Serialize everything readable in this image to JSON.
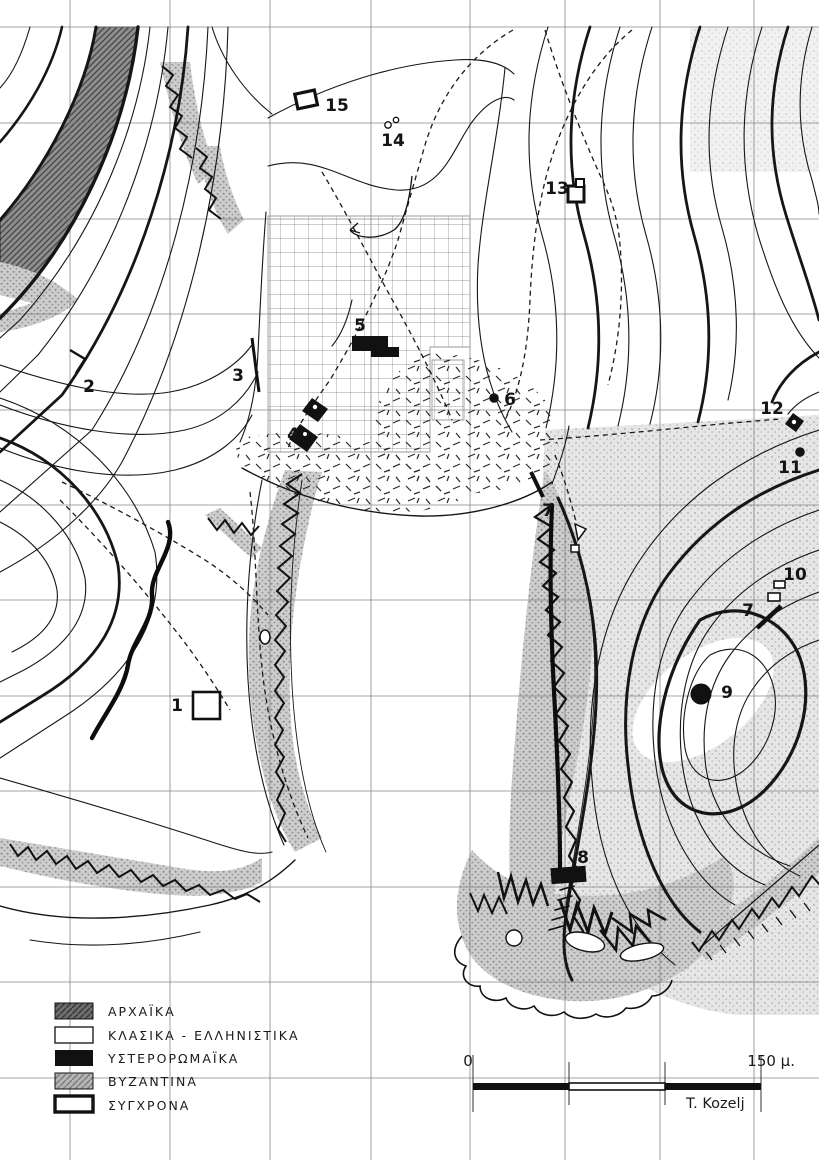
{
  "map": {
    "credit": "T. Kozelj",
    "scale_bar": {
      "start_label": "0",
      "end_label": "150 μ."
    },
    "legend": {
      "items": [
        {
          "label": "ΑΡΧΑΪΚΑ",
          "swatch": "dark-hatched",
          "period": "archaic"
        },
        {
          "label": "ΚΛΑΣΙΚΑ - ΕΛΛΗΝΙΣΤΙΚΑ",
          "swatch": "white-thin-outline",
          "period": "classical-hellenistic"
        },
        {
          "label": "ΥΣΤΕΡΟΡΩΜΑΪΚΑ",
          "swatch": "solid-black",
          "period": "late-roman"
        },
        {
          "label": "ΒΥΖΑΝΤΙΝΑ",
          "swatch": "gray-hatched",
          "period": "byzantine"
        },
        {
          "label": "ΣΥΓΧΡΟΝΑ",
          "swatch": "white-thick-outline",
          "period": "modern"
        }
      ]
    },
    "markers": [
      {
        "id": "1",
        "symbol": "open-square"
      },
      {
        "id": "2",
        "symbol": "chevron"
      },
      {
        "id": "3",
        "symbol": "line-segment"
      },
      {
        "id": "4",
        "symbol": "black-diamonds"
      },
      {
        "id": "5",
        "symbol": "black-polygon"
      },
      {
        "id": "6",
        "symbol": "black-dot"
      },
      {
        "id": "7",
        "symbol": "line-segment"
      },
      {
        "id": "7",
        "symbol": "line-segment"
      },
      {
        "id": "8",
        "symbol": "black-rectangle"
      },
      {
        "id": "9",
        "symbol": "large-black-dot"
      },
      {
        "id": "10",
        "symbol": "two-open-rectangles"
      },
      {
        "id": "11",
        "symbol": "black-dot"
      },
      {
        "id": "12",
        "symbol": "black-diamond-white-center"
      },
      {
        "id": "13",
        "symbol": "open-square"
      },
      {
        "id": "14",
        "symbol": "two-small-circles"
      },
      {
        "id": "15",
        "symbol": "open-square"
      }
    ],
    "colors": {
      "ink": "#141414",
      "grid": "#7a7a7a",
      "stipple": "#b5b5b5"
    }
  }
}
